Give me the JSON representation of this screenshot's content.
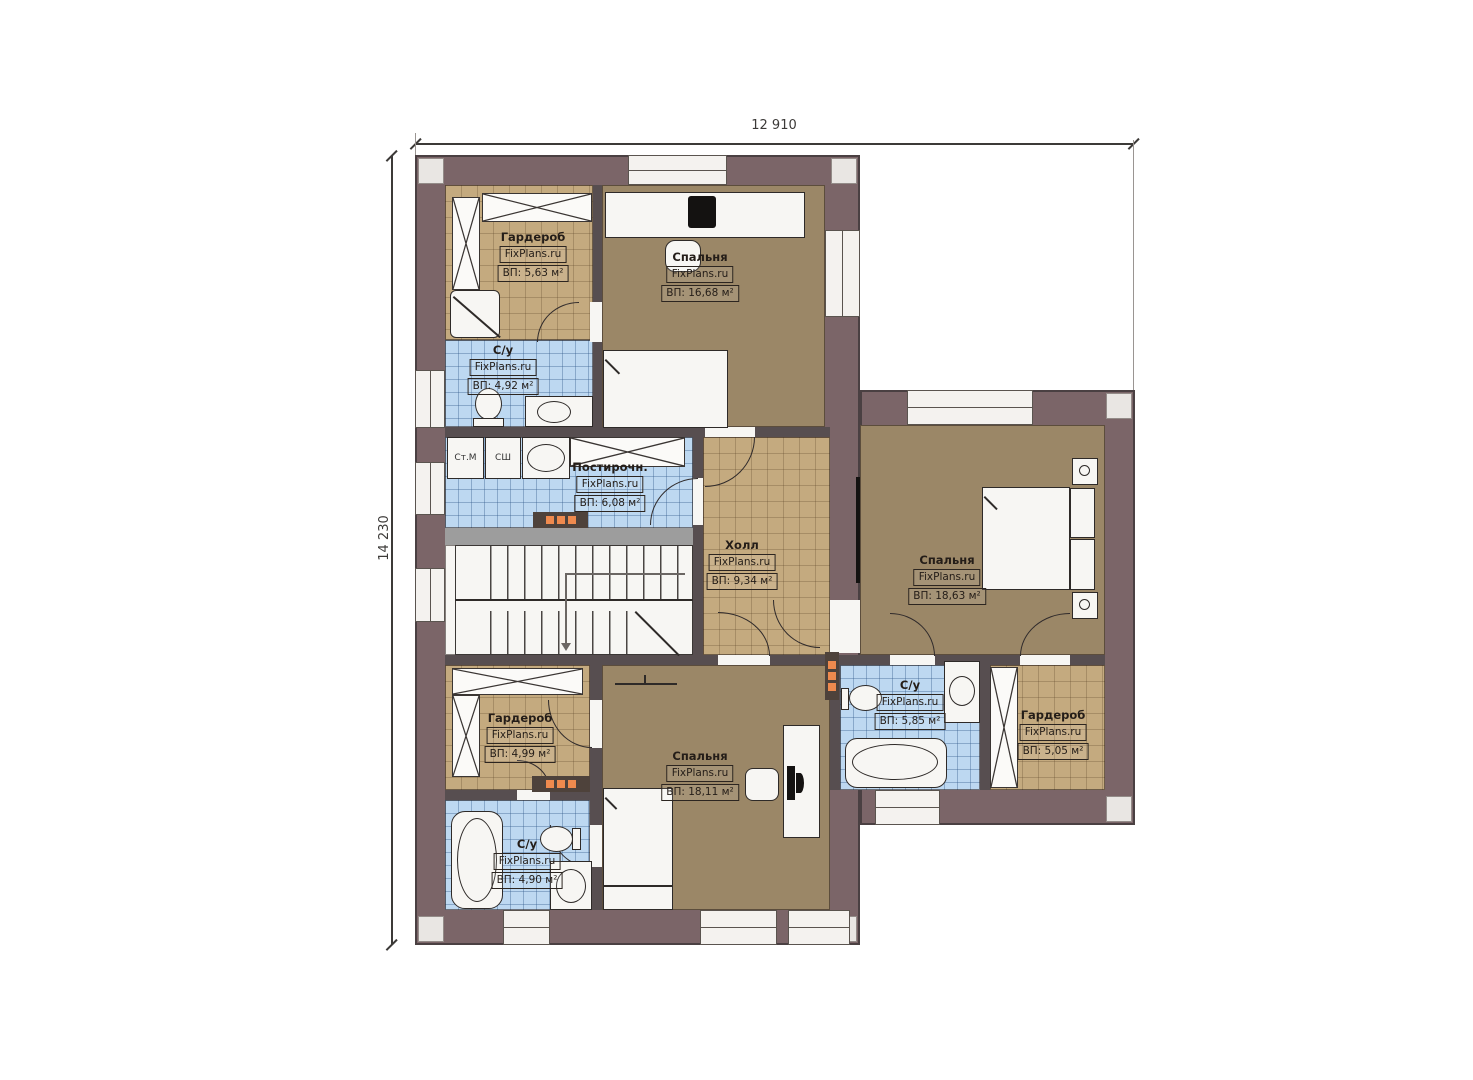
{
  "plan": {
    "dimensions": {
      "width_label": "12 910",
      "height_label": "14 230"
    },
    "rooms": {
      "wardrobe_top": {
        "name": "Гардероб",
        "source": "FixPlans.ru",
        "area": "ВП: 5,63 м²"
      },
      "bedroom_top": {
        "name": "Спальня",
        "source": "FixPlans.ru",
        "area": "ВП: 16,68 м²"
      },
      "bathroom_left": {
        "name": "С/у",
        "source": "FixPlans.ru",
        "area": "ВП: 4,92 м²"
      },
      "laundry": {
        "name": "Постирочн.",
        "source": "FixPlans.ru",
        "area": "ВП: 6,08 м²"
      },
      "hall": {
        "name": "Холл",
        "source": "FixPlans.ru",
        "area": "ВП: 9,34 м²"
      },
      "bedroom_right": {
        "name": "Спальня",
        "source": "FixPlans.ru",
        "area": "ВП: 18,63 м²"
      },
      "bathroom_right": {
        "name": "С/у",
        "source": "FixPlans.ru",
        "area": "ВП: 5,85 м²"
      },
      "wardrobe_right": {
        "name": "Гардероб",
        "source": "FixPlans.ru",
        "area": "ВП: 5,05 м²"
      },
      "wardrobe_bottom": {
        "name": "Гардероб",
        "source": "FixPlans.ru",
        "area": "ВП: 4,99 м²"
      },
      "bedroom_bottom": {
        "name": "Спальня",
        "source": "FixPlans.ru",
        "area": "ВП: 18,11 м²"
      },
      "bathroom_bottom": {
        "name": "С/у",
        "source": "FixPlans.ru",
        "area": "ВП: 4,90 м²"
      }
    },
    "appliances": {
      "washing_machine": "Ст.М",
      "drying_machine": "СШ"
    },
    "colors": {
      "wall": "#7b6568",
      "bedroom_floor": "#9b8767",
      "tile_floor": "#c4aa7f",
      "bath_floor": "#bdd8f1",
      "accent": "#ef8a4e"
    }
  }
}
